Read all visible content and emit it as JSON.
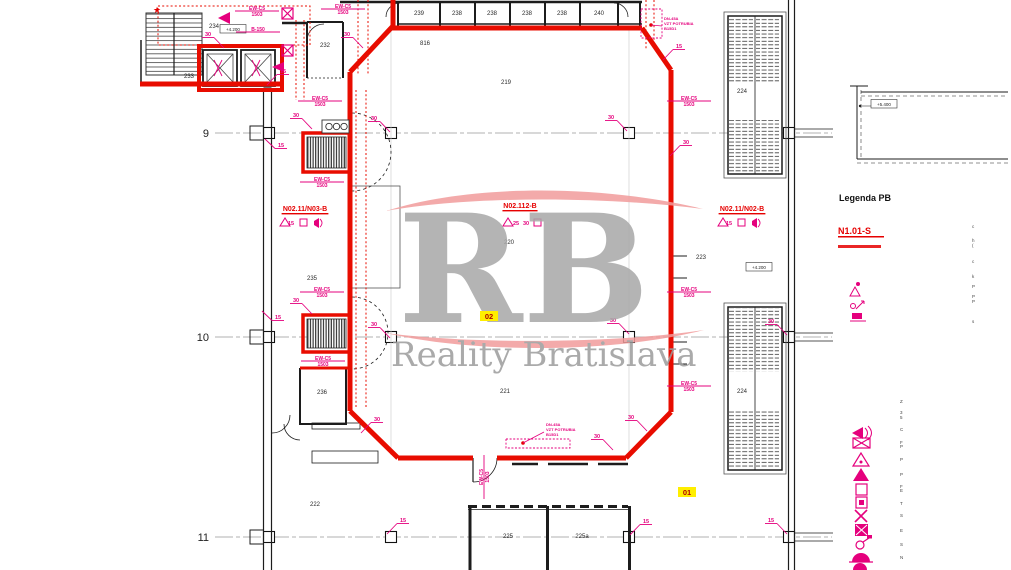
{
  "watermark": {
    "rb": "RB",
    "name": "Reality Bratislava"
  },
  "legend": {
    "title": "Legenda PB",
    "compartment": "N1.01-S",
    "upper_x": 972,
    "upper_frags": [
      {
        "t": "c",
        "y": 228
      },
      {
        "t": "h",
        "y": 242
      },
      {
        "t": "(",
        "y": 247
      },
      {
        "t": "c",
        "y": 263
      },
      {
        "t": "k",
        "y": 278
      },
      {
        "t": "P",
        "y": 288
      },
      {
        "t": "P",
        "y": 298
      },
      {
        "t": "P",
        "y": 303
      },
      {
        "t": "s",
        "y": 323
      }
    ],
    "lower_x": 900,
    "lower_frags": [
      {
        "t": "Z",
        "y": 403
      },
      {
        "t": "3",
        "y": 414
      },
      {
        "t": "5",
        "y": 419
      },
      {
        "t": "C",
        "y": 431
      },
      {
        "t": "F",
        "y": 444
      },
      {
        "t": "P",
        "y": 448
      },
      {
        "t": "P",
        "y": 461
      },
      {
        "t": "P",
        "y": 476
      },
      {
        "t": "F",
        "y": 488
      },
      {
        "t": "E",
        "y": 492
      },
      {
        "t": "T",
        "y": 505
      },
      {
        "t": "S",
        "y": 517
      },
      {
        "t": "E",
        "y": 532
      },
      {
        "t": "S",
        "y": 546
      },
      {
        "t": "N",
        "y": 559
      }
    ]
  },
  "plan": {
    "grid": {
      "rows": [
        {
          "label": "9",
          "y": 133
        },
        {
          "label": "10",
          "y": 337
        },
        {
          "label": "11",
          "y": 537
        }
      ],
      "cols": [
        269,
        391,
        629,
        789
      ],
      "x1": 215,
      "x2": 832,
      "label_x": 209
    },
    "rooms": [
      {
        "t": "232",
        "x": 325,
        "y": 47
      },
      {
        "t": "233",
        "x": 189,
        "y": 78
      },
      {
        "t": "234",
        "x": 214,
        "y": 28
      },
      {
        "t": "235",
        "x": 312,
        "y": 280
      },
      {
        "t": "236",
        "x": 322,
        "y": 394
      },
      {
        "t": "239",
        "x": 419,
        "y": 15
      },
      {
        "t": "238",
        "x": 457,
        "y": 15
      },
      {
        "t": "238",
        "x": 492,
        "y": 15
      },
      {
        "t": "238",
        "x": 527,
        "y": 15
      },
      {
        "t": "238",
        "x": 562,
        "y": 15
      },
      {
        "t": "240",
        "x": 599,
        "y": 15
      },
      {
        "t": "816",
        "x": 425,
        "y": 45
      },
      {
        "t": "219",
        "x": 506,
        "y": 84
      },
      {
        "t": "220",
        "x": 509,
        "y": 244
      },
      {
        "t": "221",
        "x": 505,
        "y": 393
      },
      {
        "t": "222",
        "x": 315,
        "y": 506
      },
      {
        "t": "223",
        "x": 701,
        "y": 259
      },
      {
        "t": "224",
        "x": 742,
        "y": 93
      },
      {
        "t": "224",
        "x": 742,
        "y": 393
      },
      {
        "t": "225",
        "x": 508,
        "y": 538
      },
      {
        "t": "225a",
        "x": 582,
        "y": 538
      }
    ],
    "elevations": [
      {
        "t": "+4.200",
        "x": 233,
        "y": 31
      },
      {
        "t": "+4.200",
        "x": 759,
        "y": 269
      },
      {
        "t": "+5.400",
        "x": 884,
        "y": 106
      }
    ],
    "tag_default": {
      "l1": "EW-C5",
      "l2": "1503"
    },
    "tags": [
      {
        "x": 320,
        "y": 100
      },
      {
        "x": 322,
        "y": 181
      },
      {
        "x": 322,
        "y": 291
      },
      {
        "x": 323,
        "y": 360
      },
      {
        "x": 689,
        "y": 100
      },
      {
        "x": 689,
        "y": 291
      },
      {
        "x": 689,
        "y": 385
      },
      {
        "x": 483,
        "y": 477,
        "rot": 1
      },
      {
        "x": 343,
        "y": 8
      },
      {
        "x": 257,
        "y": 10
      },
      {
        "x": 258,
        "y": 31,
        "single": "B-150"
      }
    ],
    "markers": [
      {
        "t": "30",
        "x": 208,
        "y": 36,
        "d": "dr"
      },
      {
        "t": "30",
        "x": 296,
        "y": 117,
        "d": "dr"
      },
      {
        "t": "30",
        "x": 347,
        "y": 36,
        "d": "dr"
      },
      {
        "t": "30",
        "x": 374,
        "y": 120,
        "d": "dr"
      },
      {
        "t": "30",
        "x": 611,
        "y": 119,
        "d": "dr"
      },
      {
        "t": "30",
        "x": 686,
        "y": 144,
        "d": "dl"
      },
      {
        "t": "30",
        "x": 296,
        "y": 302,
        "d": "dr"
      },
      {
        "t": "30",
        "x": 374,
        "y": 326,
        "d": "dr"
      },
      {
        "t": "30",
        "x": 613,
        "y": 322,
        "d": "dr"
      },
      {
        "t": "30",
        "x": 771,
        "y": 323,
        "d": "dr"
      },
      {
        "t": "30",
        "x": 631,
        "y": 419,
        "d": "dr"
      },
      {
        "t": "30",
        "x": 597,
        "y": 438,
        "d": "dr"
      },
      {
        "t": "30",
        "x": 377,
        "y": 421,
        "d": "dl"
      },
      {
        "t": "15",
        "x": 283,
        "y": 73,
        "d": "dl"
      },
      {
        "t": "15",
        "x": 281,
        "y": 147,
        "d": "ul"
      },
      {
        "t": "15",
        "x": 278,
        "y": 319,
        "d": "ul"
      },
      {
        "t": "15",
        "x": 679,
        "y": 48,
        "d": "dl"
      },
      {
        "t": "15",
        "x": 403,
        "y": 522,
        "d": "dl"
      },
      {
        "t": "15",
        "x": 646,
        "y": 523,
        "d": "dl"
      },
      {
        "t": "15",
        "x": 771,
        "y": 522,
        "d": "dr"
      },
      {
        "t": "15",
        "x": 291,
        "y": 225,
        "d": "n"
      },
      {
        "t": "15",
        "x": 729,
        "y": 225,
        "d": "n"
      },
      {
        "t": "25",
        "x": 516,
        "y": 225,
        "d": "n",
        "c": "#8e24aa"
      },
      {
        "t": "30",
        "x": 526,
        "y": 225,
        "d": "n"
      }
    ],
    "compartments": [
      {
        "t": "N02.11/N03-B",
        "x": 305,
        "y": 211
      },
      {
        "t": "N02.112-B",
        "x": 520,
        "y": 208
      },
      {
        "t": "N02.11/N02-B",
        "x": 742,
        "y": 211
      }
    ],
    "ducts": [
      {
        "x": 664,
        "y": 20,
        "lines": [
          "DN-45A",
          "VZT POTRUBIA",
          "B15D1"
        ],
        "b": [
          641,
          9,
          21,
          29
        ],
        "dot": [
          651,
          25
        ]
      },
      {
        "x": 546,
        "y": 426,
        "lines": [
          "DN-45A",
          "VZT POTRUBIA",
          "B15D1"
        ],
        "b": [
          506,
          439,
          64,
          9
        ],
        "dot": [
          523,
          443
        ]
      }
    ],
    "highlights": [
      {
        "t": "02",
        "x": 489,
        "y": 318
      },
      {
        "t": "01",
        "x": 687,
        "y": 494
      }
    ]
  }
}
